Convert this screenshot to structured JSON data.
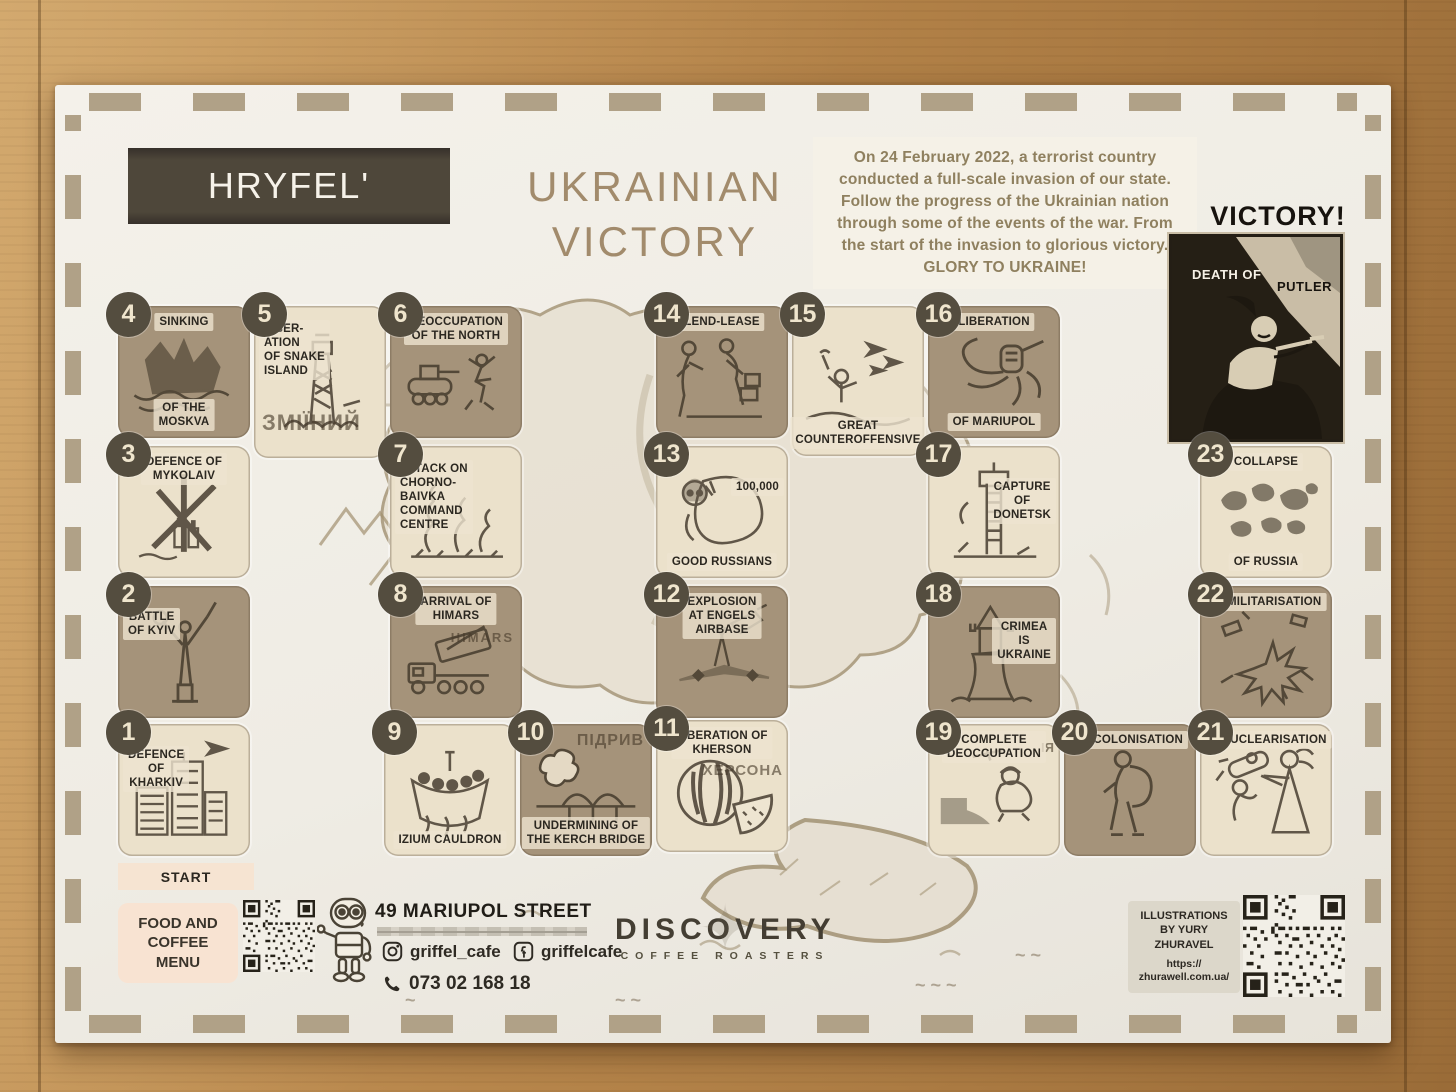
{
  "header": {
    "brand": "HRYFEL'",
    "title": "UKRAINIAN\nVICTORY",
    "intro": "On 24 February 2022,  a terrorist country\nconducted a full-scale invasion of our state.\nFollow the progress of the Ukrainian nation\nthrough some of the events of the war. From\nthe start of the invasion to glorious victory.\nGLORY TO UKRAINE!"
  },
  "victory": {
    "heading": "VICTORY!",
    "poster_label_left": "DEATH OF",
    "poster_label_right": "PUTLER"
  },
  "board": {
    "start_label": "START",
    "tiles": [
      {
        "num": "1",
        "labels": [
          "DEFENCE\nOF\nKHARKIV"
        ]
      },
      {
        "num": "2",
        "labels": [
          "BATTLE\nOF KYIV"
        ]
      },
      {
        "num": "3",
        "labels": [
          "DEFENCE OF\nMYKOLAIV"
        ]
      },
      {
        "num": "4",
        "labels": [
          "SINKING",
          "OF THE\nMOSKVA"
        ]
      },
      {
        "num": "5",
        "labels": [
          "LIBER-\nATION\nOF SNAKE\nISLAND"
        ],
        "cyr": "ЗМІЇНИЙ"
      },
      {
        "num": "6",
        "labels": [
          "DEOCCUPATION\nOF THE NORTH"
        ]
      },
      {
        "num": "7",
        "labels": [
          "ATTACK ON\nCHORNO-\nBAIVKA\nCOMMAND\nCENTRE"
        ]
      },
      {
        "num": "8",
        "labels": [
          "ARRIVAL OF\nHIMARS"
        ],
        "cyr": "HIMARS"
      },
      {
        "num": "9",
        "labels": [
          "IZIUM CAULDRON"
        ]
      },
      {
        "num": "10",
        "labels": [
          "UNDERMINING OF\nTHE KERCH BRIDGE"
        ],
        "cyr": "ПІДРИВ"
      },
      {
        "num": "11",
        "labels": [
          "LIBERATION OF\nKHERSON"
        ],
        "cyr": "ХЕРСОНА"
      },
      {
        "num": "12",
        "labels": [
          "EXPLOSION\nAT ENGELS\nAIRBASE"
        ]
      },
      {
        "num": "13",
        "labels": [
          "100,000",
          "GOOD RUSSIANS"
        ]
      },
      {
        "num": "14",
        "labels": [
          "LEND-LEASE"
        ]
      },
      {
        "num": "15",
        "labels": [
          "GREAT\nCOUNTEROFFENSIVE"
        ]
      },
      {
        "num": "16",
        "labels": [
          "LIBERATION",
          "OF MARIUPOL"
        ]
      },
      {
        "num": "17",
        "labels": [
          "CAPTURE\nOF\nDONETSK"
        ]
      },
      {
        "num": "18",
        "labels": [
          "CRIMEA\nIS\nUKRAINE"
        ]
      },
      {
        "num": "19",
        "labels": [
          "COMPLETE\nDEOCCUPATION"
        ],
        "cyr": "ІЯ"
      },
      {
        "num": "20",
        "labels": [
          "DECOLONISATION"
        ]
      },
      {
        "num": "21",
        "labels": [
          "DENUCLEARISATION"
        ]
      },
      {
        "num": "22",
        "labels": [
          "DEMILITARISATION"
        ]
      },
      {
        "num": "23",
        "labels": [
          "COLLAPSE",
          "OF RUSSIA"
        ]
      }
    ]
  },
  "footer": {
    "menu_label": "FOOD AND\nCOFFEE\nMENU",
    "address": "49 MARIUPOL STREET",
    "instagram": "griffel_cafe",
    "facebook": "griffelcafe",
    "phone": "073 02 168 18",
    "roaster_name": "DISCOVERY",
    "roaster_tagline": "COFFEE ROASTERS",
    "credit": "ILLUSTRATIONS\nBY YURY\nZHURAVEL",
    "credit_url": "https://\nzhurawell.com.ua/"
  },
  "colors": {
    "brand_box": "#4e473a",
    "title_text": "#a28b6c",
    "intro_text": "#8f805f",
    "tile_dark": "#a5937a",
    "tile_light": "#ebe1cb",
    "number_circle": "#544d3f",
    "label_text": "#2b2720",
    "paper": "#f0ece4",
    "wood": "#b8874c",
    "start_bar": "#f6e4d2"
  }
}
